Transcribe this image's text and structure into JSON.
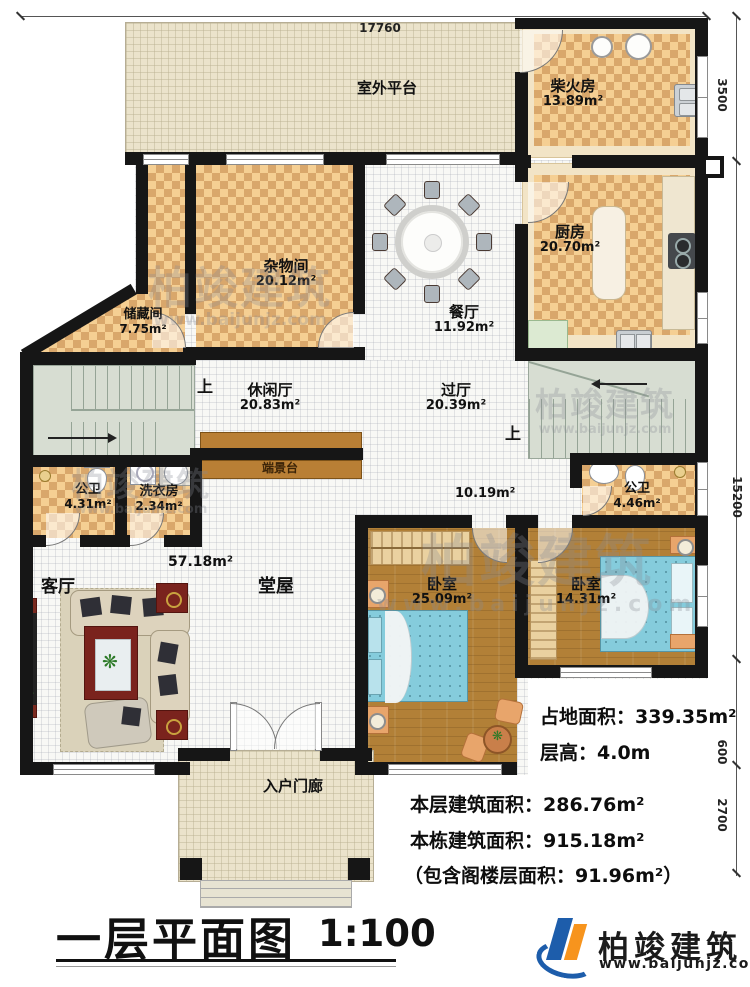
{
  "meta": {
    "sheet_title": "一层平面图",
    "scale_label": "1:100"
  },
  "rooms": [
    {
      "name": "室外平台",
      "area": ""
    },
    {
      "name": "柴火房",
      "area": "13.89m²"
    },
    {
      "name": "厨房",
      "area": "20.70m²"
    },
    {
      "name": "杂物间",
      "area": "20.12m²"
    },
    {
      "name": "储藏间",
      "area": "7.75m²"
    },
    {
      "name": "餐厅",
      "area": "11.92m²"
    },
    {
      "name": "休闲厅",
      "area": "20.83m²"
    },
    {
      "name": "过厅",
      "area": "20.39m²"
    },
    {
      "name": "公卫",
      "area": "4.31m²"
    },
    {
      "name": "洗衣房",
      "area": "2.34m²"
    },
    {
      "name": "端景台",
      "area": ""
    },
    {
      "name": "公卫",
      "area": "4.46m²"
    },
    {
      "name": "客厅",
      "area": ""
    },
    {
      "name": "堂屋",
      "area": ""
    },
    {
      "name": "卧室",
      "area": "25.09m²"
    },
    {
      "name": "卧室",
      "area": "14.31m²"
    },
    {
      "name": "入户门廊",
      "area": ""
    }
  ],
  "floating_areas": {
    "hall_area": "57.18m²",
    "corridor_area": "10.19m²"
  },
  "stairs": {
    "up_label": "上"
  },
  "dimensions": {
    "top_width": "17760",
    "right_top": "3500",
    "right_main": "15200",
    "right_lower_a": "600",
    "right_lower_b": "2700"
  },
  "info": {
    "land_area": "占地面积：339.35m²",
    "floor_height": "层高：4.0m",
    "this_floor_area": "本层建筑面积：286.76m²",
    "building_area": "本栋建筑面积：915.18m²",
    "attic_note": "（包含阁楼层面积：91.96m²）"
  },
  "branding": {
    "company": "柏竣建筑",
    "website": "www.baijunjz.com"
  },
  "watermark": {
    "text": "柏竣建筑",
    "url": "www.baijunjz.com"
  },
  "colors": {
    "wall": "#161616",
    "checker_dark": "#d9a76b",
    "checker_light": "#f5cf93",
    "wood_floor": "#b28037",
    "stair": "#d7ddd2",
    "platform": "#ebe3cb",
    "bed_blue": "#85ccdc",
    "brand_blue": "#1d5dab",
    "brand_orange": "#f7941d"
  }
}
